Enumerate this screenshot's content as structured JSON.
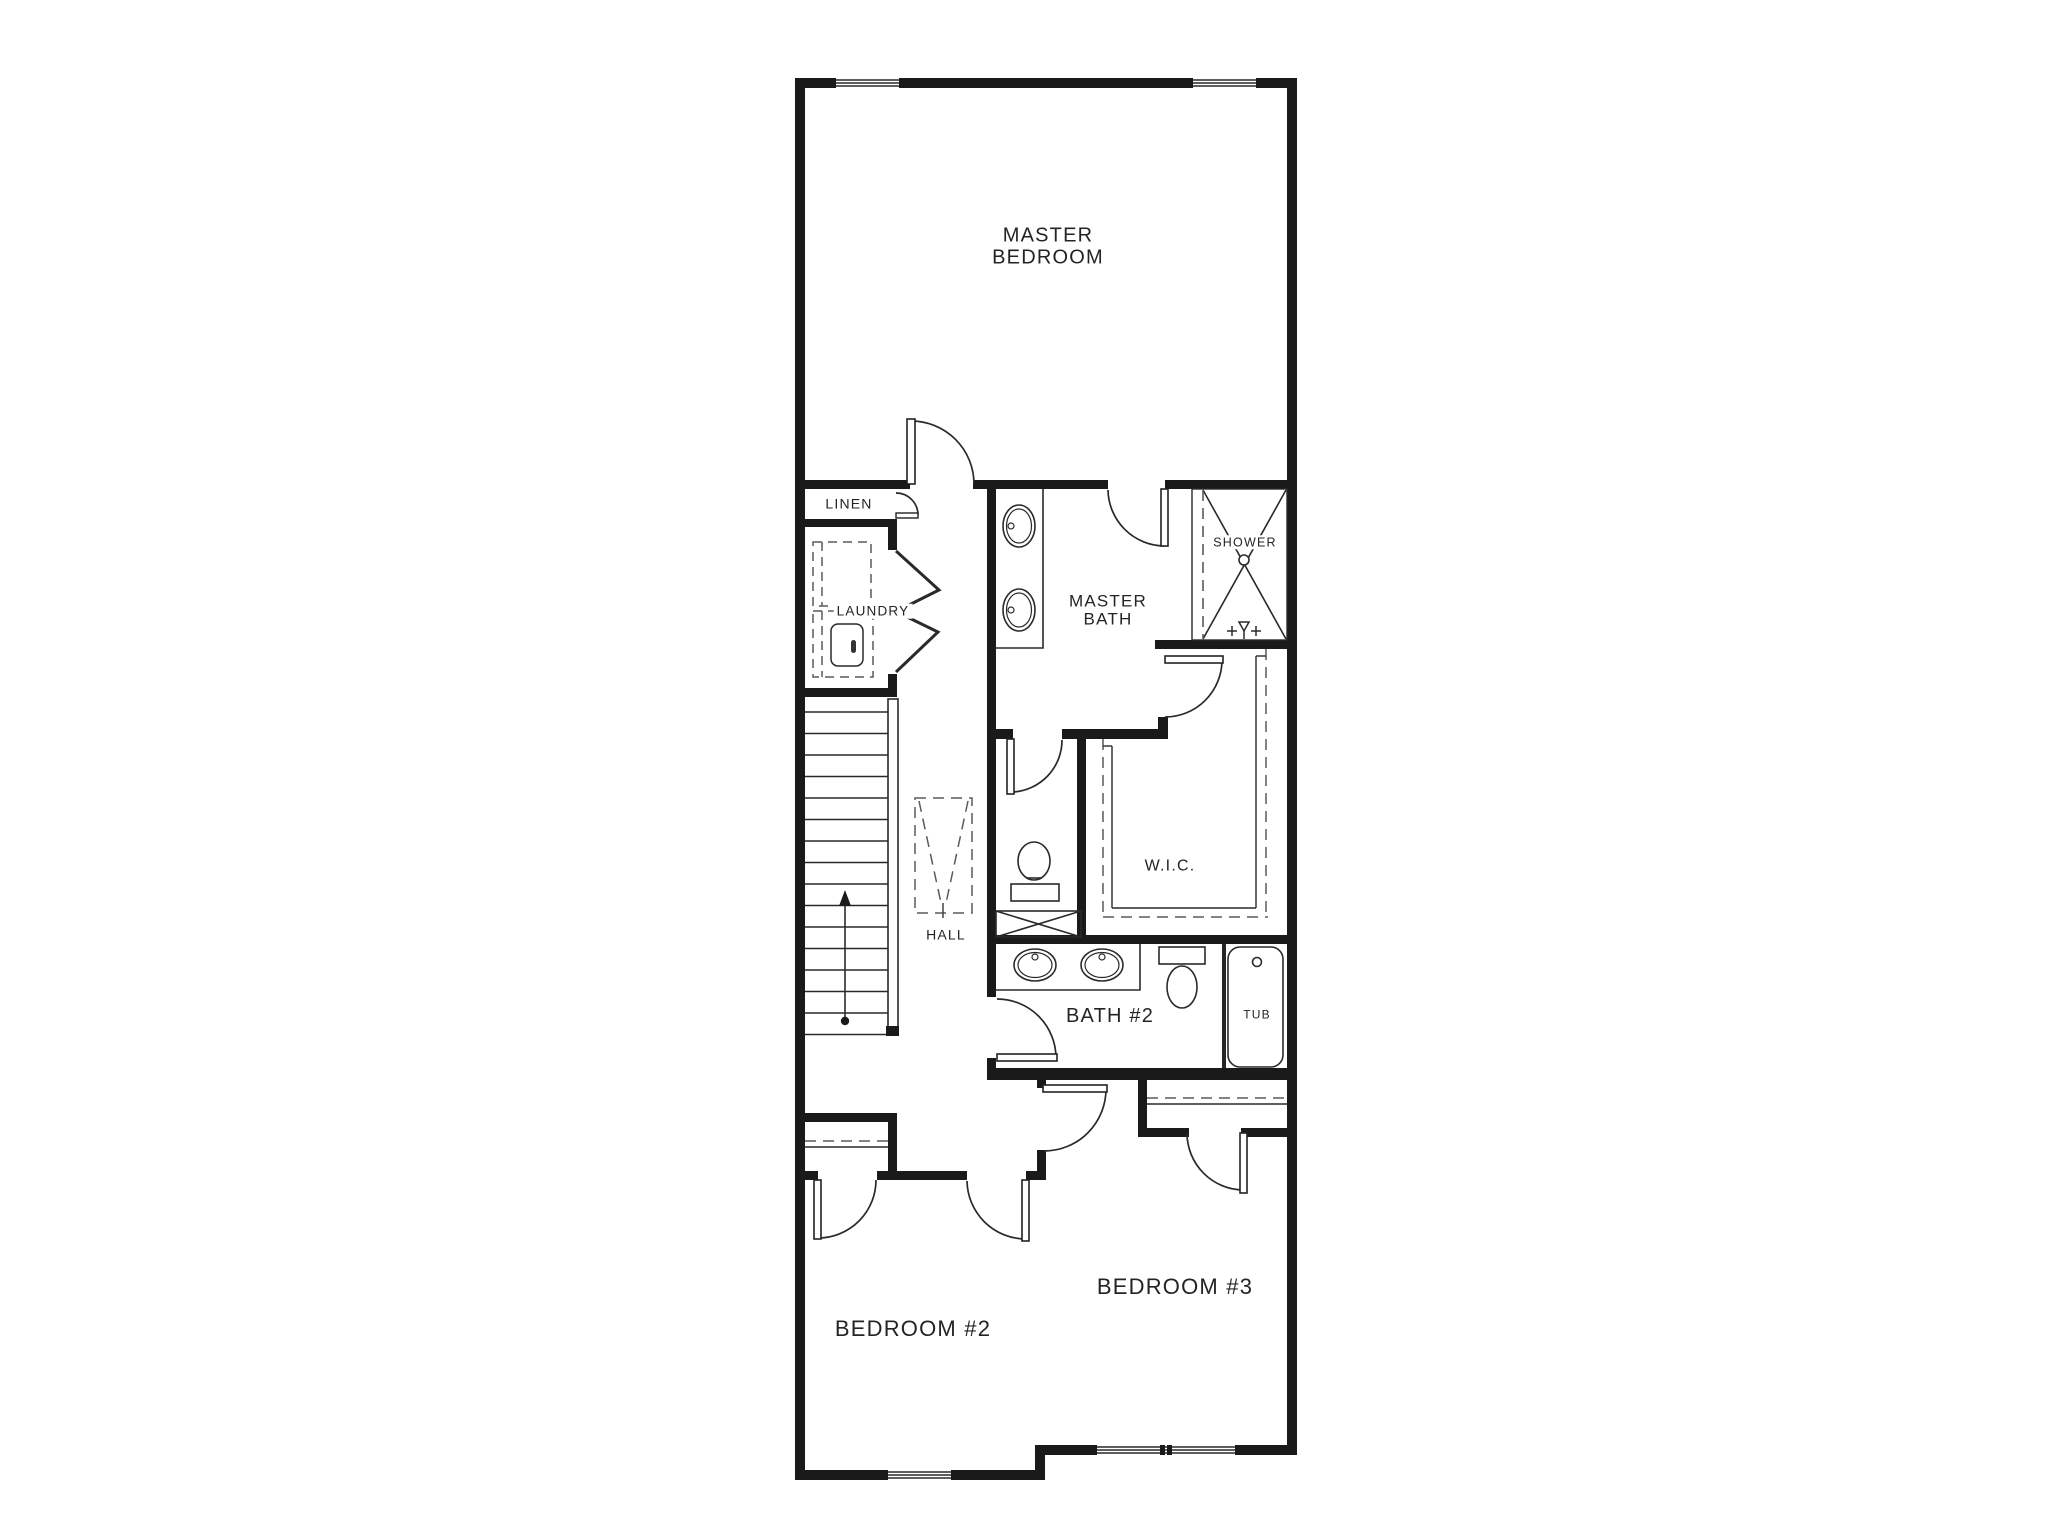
{
  "drawing": {
    "kind": "architectural floor plan",
    "colors": {
      "wall": "#1a1a1a",
      "line": "#2a2a2a",
      "dashed": "#5a5a5a",
      "background": "#ffffff"
    }
  },
  "labels": {
    "master_bedroom_line1": "MASTER",
    "master_bedroom_line2": "BEDROOM",
    "master_bath_line1": "MASTER",
    "master_bath_line2": "BATH",
    "linen": "LINEN",
    "laundry": "LAUNDRY",
    "shower": "SHOWER",
    "wic": "W.I.C.",
    "hall": "HALL",
    "bath2": "BATH #2",
    "tub": "TUB",
    "bedroom2": "BEDROOM #2",
    "bedroom3": "BEDROOM #3"
  }
}
